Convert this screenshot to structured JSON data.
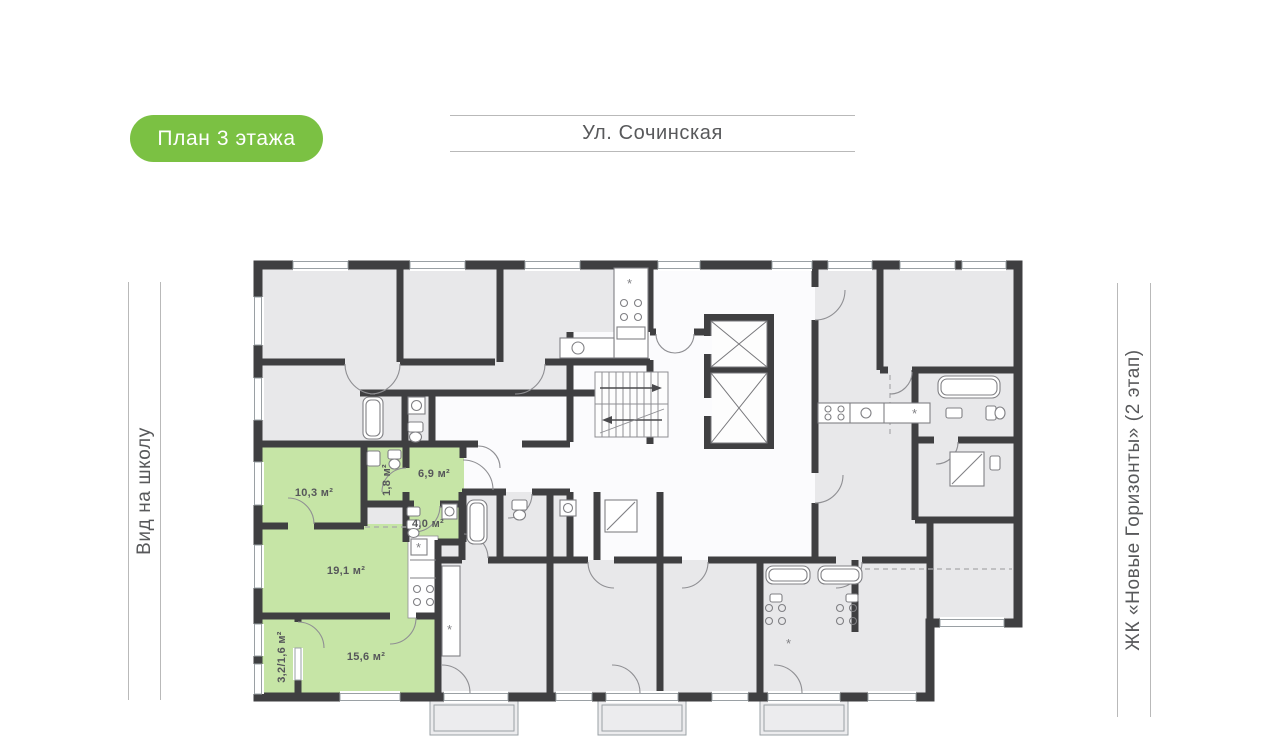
{
  "badge": {
    "label": "План 3 этажа",
    "bg_color": "#7bc143",
    "text_color": "#ffffff"
  },
  "street": {
    "label": "Ул. Сочинская"
  },
  "side_labels": {
    "left": "Вид на школу",
    "right": "ЖК «Новые Горизонты» (2 этап)"
  },
  "plan": {
    "highlighted_apartment": {
      "rooms": [
        {
          "id": "room-10-3",
          "area_label": "10,3 м²"
        },
        {
          "id": "bathroom-1-8",
          "area_label": "1,8 м²"
        },
        {
          "id": "hall-6-9",
          "area_label": "6,9 м²"
        },
        {
          "id": "bathroom-4-0",
          "area_label": "4,0 м²"
        },
        {
          "id": "living-19-1",
          "area_label": "19,1 м²"
        },
        {
          "id": "room-15-6",
          "area_label": "15,6 м²"
        },
        {
          "id": "balcony",
          "area_label": "3,2/1,6 м²"
        }
      ]
    },
    "icons": {
      "fridge_glyph": "*"
    },
    "colors": {
      "highlight_green": "#c6e5a6",
      "room_gray": "#e8e8ea",
      "wall_dark": "#3f3f41",
      "fixture_gray": "#808084",
      "window_gray": "#9aa0a4",
      "guide_line_gray": "#b9b9b9",
      "label_text": "#56575a"
    }
  }
}
